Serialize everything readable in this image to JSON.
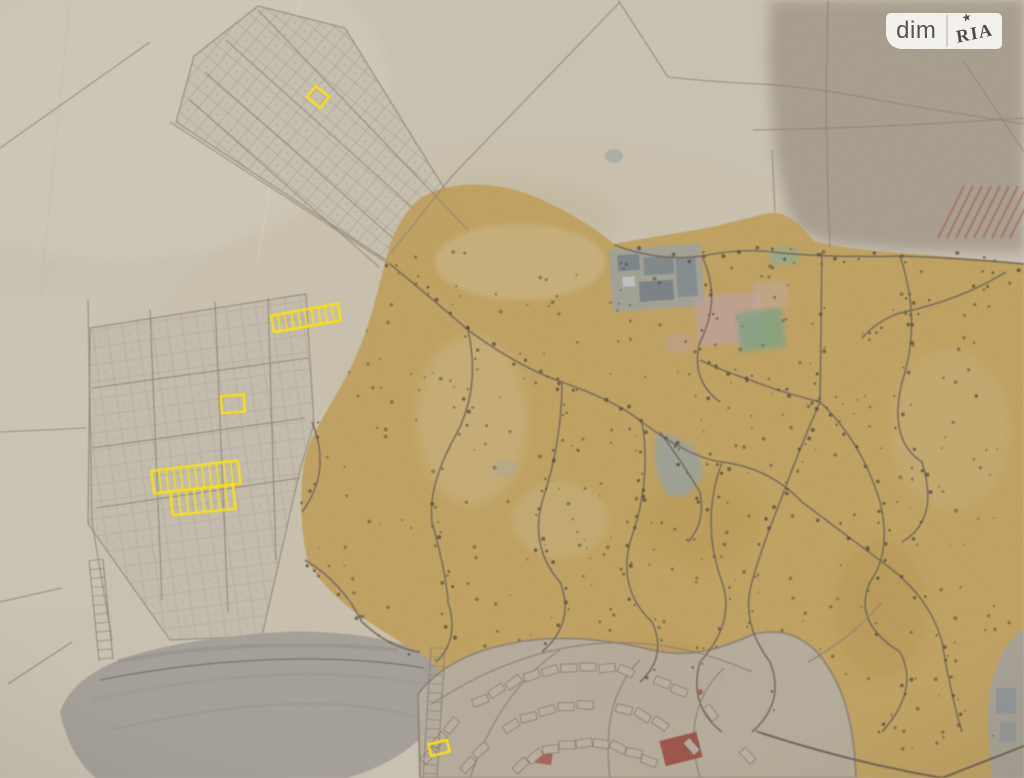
{
  "watermark": {
    "left": "dim",
    "right": "RIA",
    "star": "★"
  },
  "map": {
    "palette": {
      "paper": "#cbc3b4",
      "paper-light": "#d6cfc1",
      "paper-dark": "#a69c8e",
      "ochre": "#c2a159",
      "ochre-light": "#d2bd92",
      "road": "#77695a",
      "field-line": "#8d8274",
      "lake": "#a3a09a",
      "town": "#b7aea1",
      "buildings": "#9aa2a4",
      "pink": "#c2a2a8",
      "green": "#7fa484",
      "red": "#9c4a3e",
      "hatch": "#b06a54",
      "dots": "#4e4537",
      "highlight": "#ffe40a",
      "badge-bg": "#f8f6f3",
      "badge-text": "#55514b",
      "badge-divider": "#d8d4cd"
    },
    "highlight_plots": [
      {
        "label": "plot-northwest",
        "cx": 318,
        "cy": 97,
        "w": 17,
        "h": 14,
        "rot": 40,
        "divisions": 1
      },
      {
        "label": "plot-strip",
        "cx": 306,
        "cy": 318,
        "w": 68,
        "h": 17,
        "rot": -10,
        "divisions": 10
      },
      {
        "label": "plot-small",
        "cx": 233,
        "cy": 404,
        "w": 23,
        "h": 17,
        "rot": -5,
        "divisions": 1
      },
      {
        "label": "plot-block-upper",
        "cx": 196,
        "cy": 477,
        "w": 87,
        "h": 23,
        "rot": -7,
        "divisions": 12
      },
      {
        "label": "plot-block-lower",
        "cx": 203,
        "cy": 500,
        "w": 63,
        "h": 24,
        "rot": -6,
        "divisions": 8
      },
      {
        "label": "plot-south",
        "cx": 439,
        "cy": 748,
        "w": 19,
        "h": 12,
        "rot": -14,
        "divisions": 1
      }
    ]
  }
}
